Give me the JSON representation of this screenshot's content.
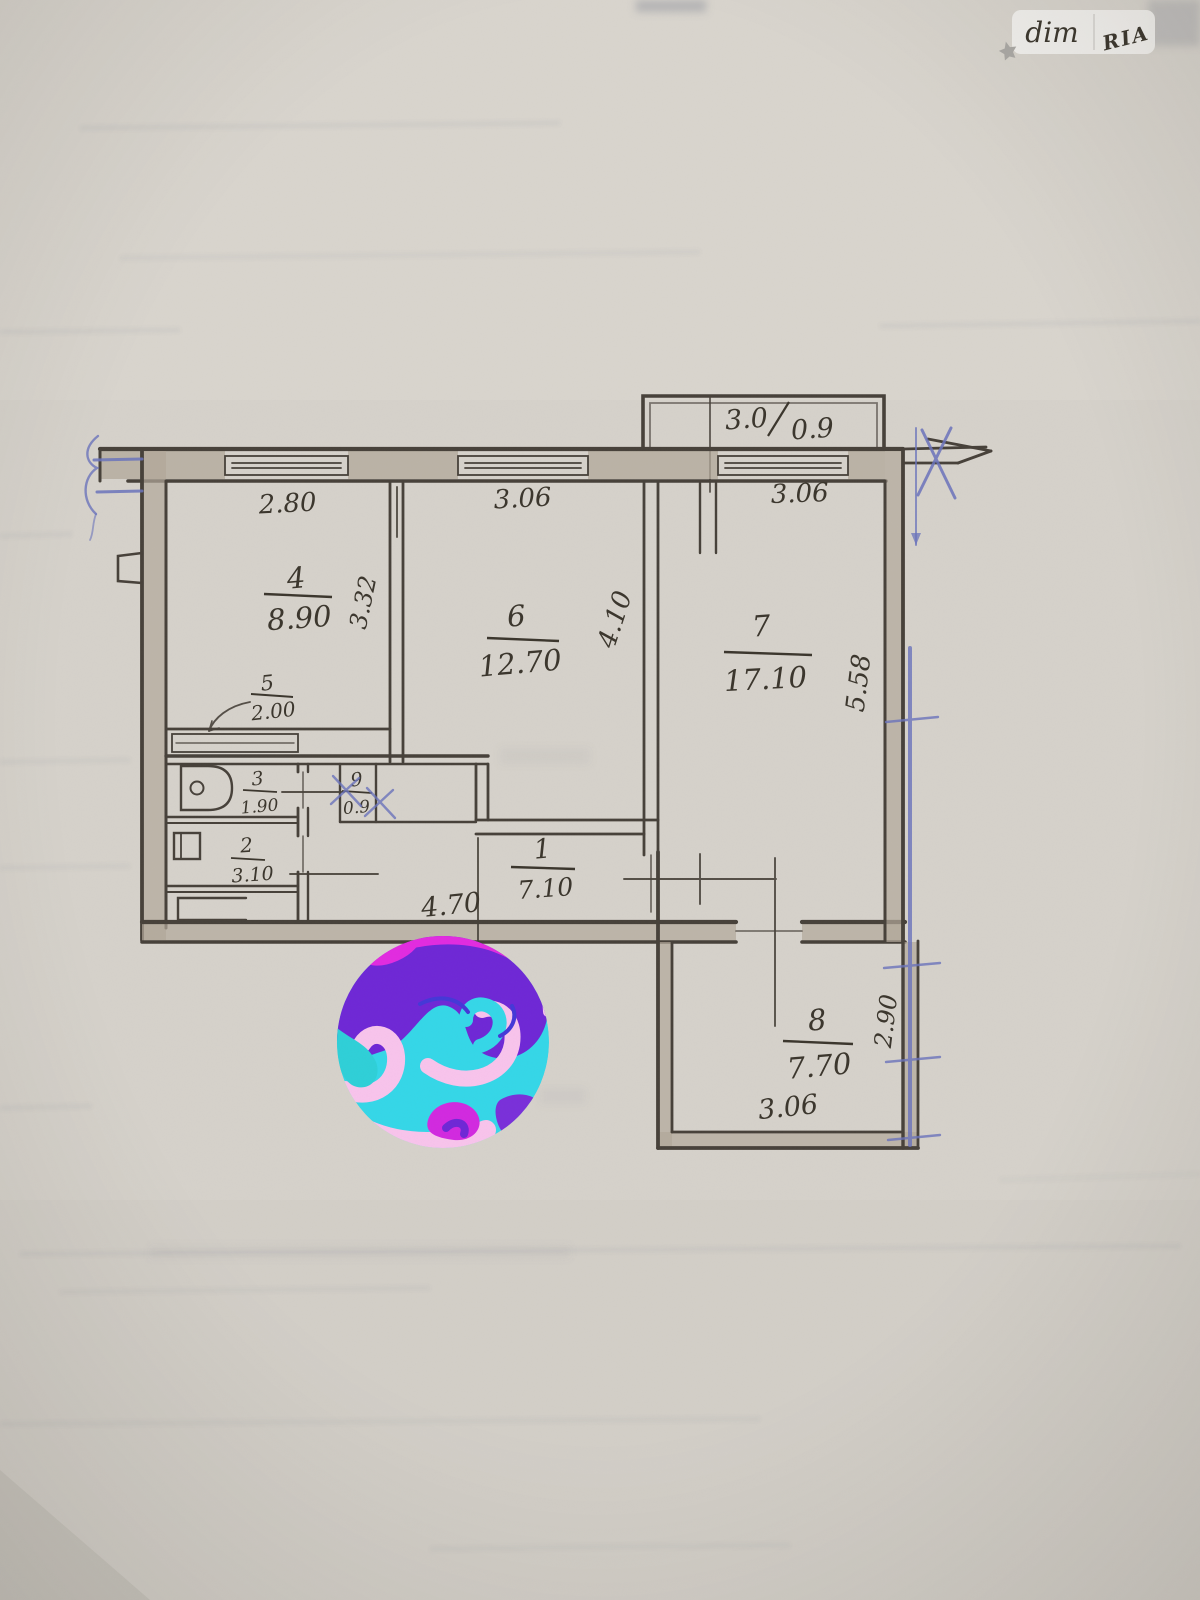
{
  "watermark": {
    "left": "dim",
    "right": "RIA"
  },
  "colors": {
    "paper": "#d6d2cb",
    "pencil": "#46403a",
    "pen_blue": "#6b74bc",
    "wall_fill": "#b2a89a",
    "watermark_text": "#a7a5a1",
    "swirl_palette": [
      "#6f28d6",
      "#e22ce0",
      "#35d7e8",
      "#f8c4ec"
    ]
  },
  "plan": {
    "balcony": {
      "width_m": "3.0",
      "depth_m": "0.9"
    },
    "top_dims": {
      "room4_width": "2.80",
      "room6_width": "3.06",
      "room7_width": "3.06"
    },
    "rooms": {
      "r1": {
        "id": "1",
        "area": "7.10"
      },
      "r2": {
        "id": "2",
        "area": "3.10"
      },
      "r3": {
        "id": "3",
        "area": "1.90"
      },
      "r4": {
        "id": "4",
        "area": "8.90"
      },
      "r5": {
        "id": "5",
        "area": "2.00"
      },
      "r6": {
        "id": "6",
        "area": "12.70"
      },
      "r7": {
        "id": "7",
        "area": "17.10"
      },
      "r8": {
        "id": "8",
        "area": "7.70"
      },
      "r9": {
        "id": "9",
        "area": "0.9"
      }
    },
    "side_dims": {
      "room4_depth": "3.32",
      "room6_depth": "4.10",
      "room7_depth": "5.58",
      "room8_depth": "2.90"
    },
    "bottom_dims": {
      "hall_width": "4.70",
      "room8_width": "3.06"
    }
  }
}
